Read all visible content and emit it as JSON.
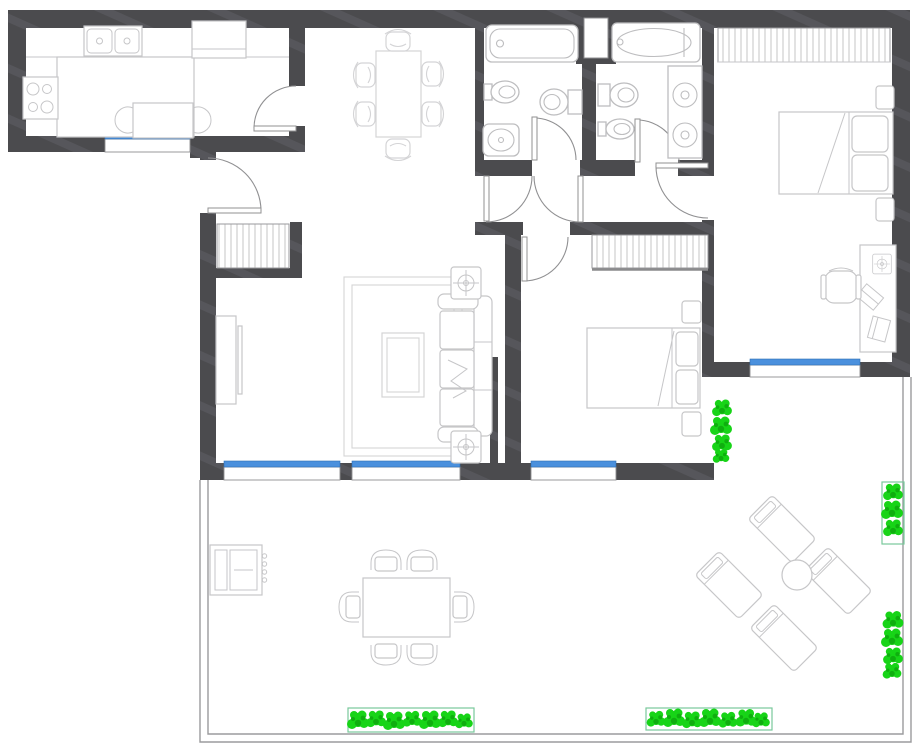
{
  "app": {
    "name": "apartment-floor-plan",
    "description": "Monochrome CAD-style floor plan of a two-bedroom apartment with two bathrooms, open kitchen/dining/living area and a large wrap-around terrace. No text labels are rendered on the drawing."
  },
  "canvas": {
    "width": 920,
    "height": 752
  },
  "colors": {
    "background": "#ffffff",
    "wall": "#4b4b4e",
    "wallStreak": "#56565b",
    "furniture": "#c6c6c8",
    "furnitureLight": "#d4d4d6",
    "fixture": "#bdbdbf",
    "windowGlass": "#4a90dd",
    "frame": "#8f8f91",
    "doorArc": "#909092",
    "terraceLine": "#9b9b9d",
    "plantGreen": "#17d417",
    "plantGreenDark": "#0fae0f",
    "planterBorder": "#79c99b"
  },
  "rooms": [
    {
      "id": "kitchen",
      "position": "top-left",
      "furniture": [
        "counter-island",
        "double-basin-sink",
        "cooktop-4-burners",
        "refrigerator",
        "breakfast-table-with-2-chairs",
        "window"
      ]
    },
    {
      "id": "dining-area",
      "position": "top-center",
      "furniture": [
        "dining-table",
        "6-chairs"
      ]
    },
    {
      "id": "bathroom-1",
      "position": "top-center-right",
      "furniture": [
        "bathtub",
        "bidet",
        "toilet",
        "washbasin",
        "door"
      ]
    },
    {
      "id": "bathroom-2",
      "position": "top-right-of-center",
      "furniture": [
        "bathtub",
        "toilet",
        "bidet",
        "double-vanity",
        "door",
        "wall-niche"
      ]
    },
    {
      "id": "master-bedroom",
      "position": "top-right",
      "furniture": [
        "wardrobe-hatched",
        "double-bed",
        "2-nightstands",
        "desk",
        "desk-lamp",
        "laptop",
        "notebook",
        "office-chair",
        "window"
      ]
    },
    {
      "id": "bedroom-2",
      "position": "center",
      "furniture": [
        "wardrobe-hatched",
        "double-bed",
        "2-nightstands",
        "window",
        "door"
      ]
    },
    {
      "id": "living-room",
      "position": "center-left",
      "furniture": [
        "entry-closet-hatched",
        "tv-unit",
        "rug",
        "coffee-table",
        "3-seat-sofa",
        "2-side-tables-with-plants",
        "2-windows",
        "entry-door"
      ]
    },
    {
      "id": "hallway",
      "position": "center",
      "furniture": [
        "4-door-swings"
      ]
    },
    {
      "id": "terrace",
      "position": "bottom",
      "furniture": [
        "bbq-grill",
        "outdoor-dining-table",
        "6-outdoor-chairs",
        "4-sun-loungers",
        "round-side-table",
        "parapet"
      ]
    }
  ],
  "counts": {
    "windows": 5,
    "door-swings": 8,
    "bordered-planters": 3,
    "shrub-clusters": 5
  }
}
